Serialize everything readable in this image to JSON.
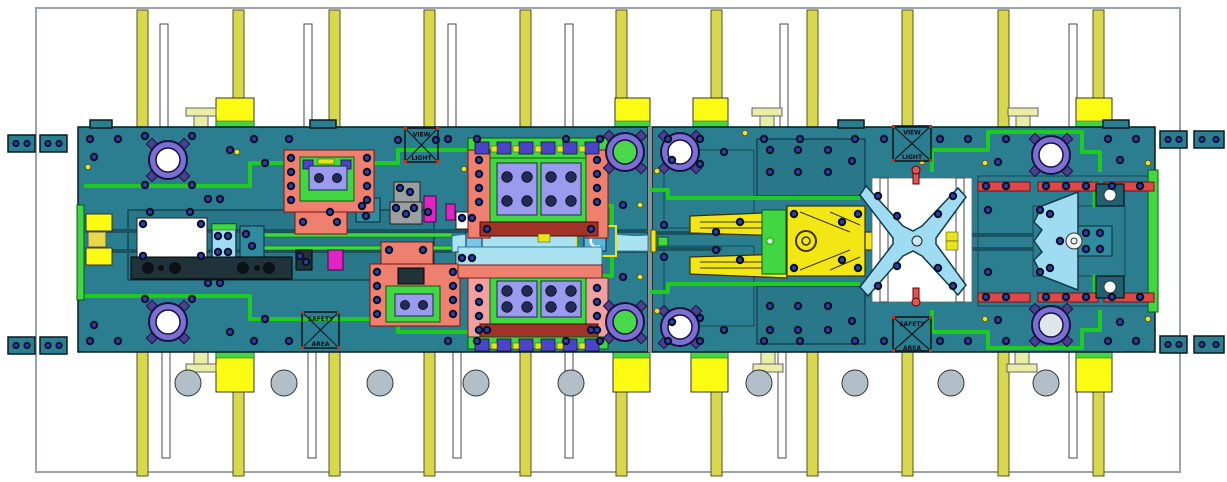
{
  "canvas": {
    "width": 1227,
    "height": 482,
    "background": "#ffffff"
  },
  "markers": {
    "upper_left_box": {
      "line1": "VIEW",
      "line2": "LIGHT"
    },
    "upper_right_box": {
      "line1": "VIEW",
      "line2": "LIGHT"
    },
    "lower_left_box": {
      "line1": "SAFETY",
      "line2": "AREA"
    },
    "lower_right_box": {
      "line1": "SAFETY",
      "line2": "AREA"
    }
  },
  "colors": {
    "plate_teal": "#2a7e90",
    "route_green": "#1ecb1e",
    "bright_green": "#42d742",
    "pillar_yellow": "#d8d84e",
    "block_yellow": "#fcfc12",
    "clamp_pale": "#e9eda6",
    "salmon": "#ef8070",
    "dark_red": "#a03228",
    "periwinkle": "#9a9aee",
    "navy_bolt": "#2a3fae",
    "light_blue": "#9fdcf2",
    "strip_blue": "#a9e2f0",
    "roller_gray": "#b2bfc8",
    "magenta": "#e224c4",
    "part_yellow": "#f2e713",
    "bushing_purple": "#7a6fd2"
  }
}
